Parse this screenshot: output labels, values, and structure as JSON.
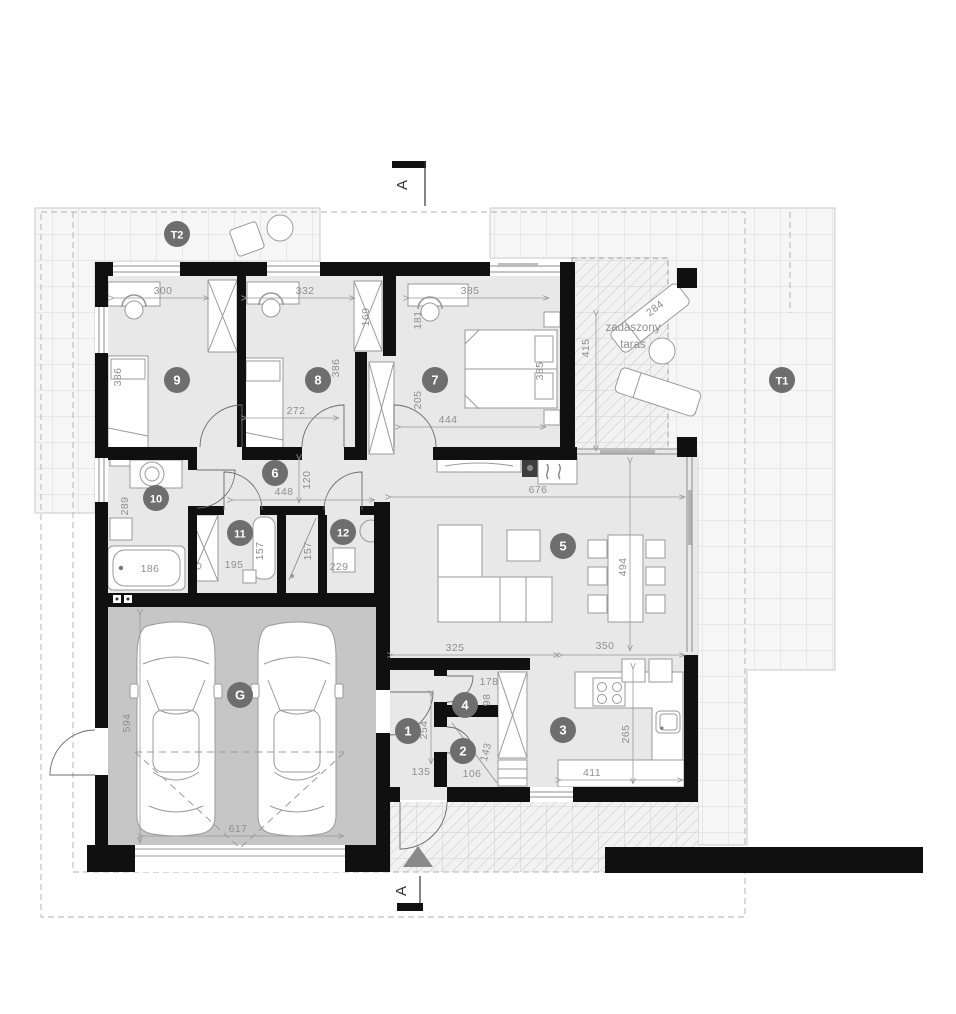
{
  "plan_labels": {
    "section_letter_top": "A",
    "section_letter_bottom": "A",
    "covered_terrace_line1": "zadaszony",
    "covered_terrace_line2": "taras"
  },
  "badges": {
    "t2": "T2",
    "t1": "T1",
    "r9": "9",
    "r8": "8",
    "r7": "7",
    "r6": "6",
    "r10": "10",
    "r11": "11",
    "r12": "12",
    "r5": "5",
    "g": "G",
    "r1": "1",
    "r2": "2",
    "r4": "4",
    "r3": "3"
  },
  "dims": {
    "w300": "300",
    "w332": "332",
    "w385_top": "385",
    "h169": "169",
    "h181": "181",
    "h386_r9": "386",
    "h386_r8": "386",
    "h205": "205",
    "w272": "272",
    "w444": "444",
    "h385_r7": "385",
    "h415": "415",
    "w284": "284",
    "w448": "448",
    "h120": "120",
    "h289": "289",
    "w186": "186",
    "w195": "195",
    "h157_a": "157",
    "h157_b": "157",
    "w229": "229",
    "w676": "676",
    "h494": "494",
    "w325": "325",
    "w350": "350",
    "h265": "265",
    "w411": "411",
    "h254": "254",
    "w135": "135",
    "w106": "106",
    "h143": "143",
    "w178": "178",
    "h98": "98",
    "h594": "594",
    "w617": "617"
  },
  "colors": {
    "wall": "#101010",
    "room_floor": "#e8e8e8",
    "garage_floor": "#c6c6c6",
    "badge_fill": "#6e6e6e",
    "dim_text": "#8f8f8f",
    "terrace_grid_line": "#d9d9d9"
  }
}
